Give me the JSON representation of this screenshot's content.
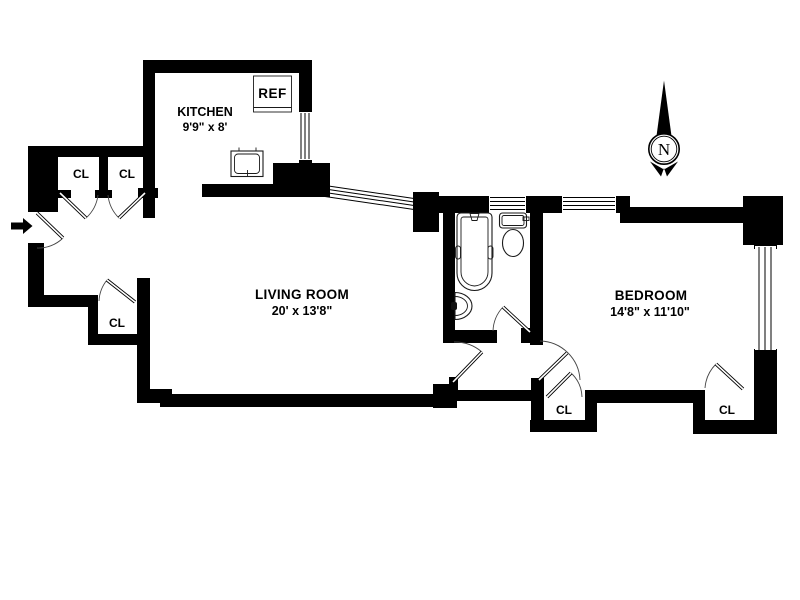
{
  "document": {
    "type": "apartment-floor-plan"
  },
  "rooms": {
    "kitchen": {
      "name": "KITCHEN",
      "dims": "9'9\" x 8'"
    },
    "living_room": {
      "name": "LIVING ROOM",
      "dims": "20' x 13'8\""
    },
    "bedroom": {
      "name": "BEDROOM",
      "dims": "14'8\" x 11'10\""
    }
  },
  "closets": [
    "CL",
    "CL",
    "CL",
    "CL",
    "CL"
  ],
  "appliances": {
    "refrigerator": "REF"
  },
  "fixtures": [
    "bathtub",
    "toilet",
    "bathroom-sink",
    "kitchen-sink"
  ],
  "compass": {
    "north": "N"
  },
  "icons": [
    "entry-arrow",
    "north-compass",
    "door-swing",
    "window"
  ],
  "colors": {
    "wall": "#000000",
    "background": "#ffffff",
    "line": "#1a1a1a"
  }
}
